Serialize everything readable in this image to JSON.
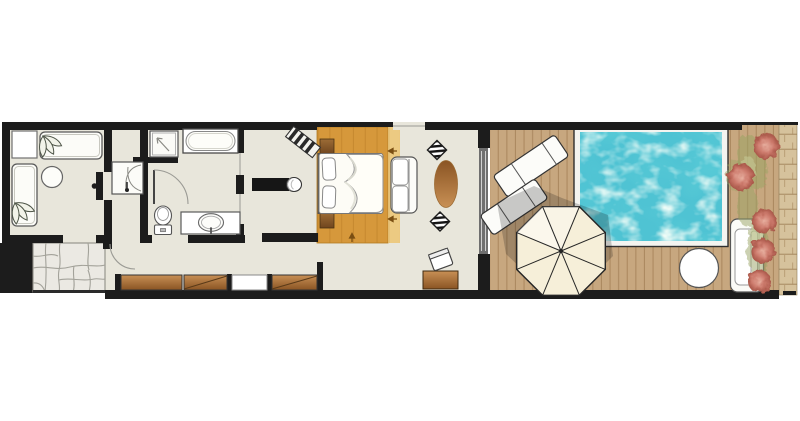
{
  "plan": {
    "label": "resort-suite-floor-plan-with-private-pool",
    "areas": [
      {
        "name": "sitting-room",
        "items": [
          "armchair",
          "daybed-horizontal",
          "daybed-vertical",
          "round-side-table",
          "potted-plant",
          "potted-plant",
          "pivot-door"
        ]
      },
      {
        "name": "wardrobe-hall",
        "items": [
          "wardrobe"
        ]
      },
      {
        "name": "bathroom",
        "items": [
          "shower",
          "bathtub",
          "toilet",
          "washbasin-vanity",
          "door-swing"
        ]
      },
      {
        "name": "dressing-corridor",
        "items": [
          "closet-panel",
          "closet-panel",
          "closet-panel-white",
          "closet-panel"
        ]
      },
      {
        "name": "entry",
        "items": [
          "stone-path",
          "entry-door-swing"
        ]
      },
      {
        "name": "bedroom",
        "items": [
          "bed-platform",
          "double-bed",
          "pillow",
          "pillow",
          "nightstand",
          "nightstand",
          "headboard",
          "tv-console",
          "luggage-bench",
          "sofa",
          "oval-coffee-table",
          "zebra-pouf",
          "zebra-pouf",
          "writing-desk",
          "desk-chair",
          "window",
          "sliding-glass-door"
        ]
      },
      {
        "name": "pool-deck",
        "items": [
          "sun-lounger",
          "sun-lounger",
          "parasol",
          "parasol-shadow",
          "plunge-pool",
          "round-side-table",
          "outdoor-daybed",
          "flower-bed",
          "stone-wall"
        ]
      }
    ]
  },
  "colors": {
    "wall": "#1c1c1c",
    "floor": "#e8e6db",
    "outline": "#4a4a4a",
    "wood-platform": "#d6983b",
    "wood-platform-light": "#ecca82",
    "wood-grain": "#b97e26",
    "furniture-wood-light": "#c89055",
    "furniture-wood-dark": "#8a5423",
    "nightstand-light": "#9c6c36",
    "nightstand-dark": "#6f451e",
    "deck": "#c7a77f",
    "deck-line": "#a27e55",
    "pool-border": "#f4f4f0",
    "pool-water": "#4fc3d3",
    "umbrella": "#f6efd9",
    "white-furniture": "#fcfcf8",
    "stone-path": "#ebe9e3",
    "stone-line": "#a3a29a",
    "stone-wall": "#d6c29c",
    "stone-wall-line": "#ab8f66",
    "flower": "#cd7b6d",
    "flower-light": "#e8b0a0",
    "flower-deep": "#a85648",
    "foliage": "#9aa465"
  }
}
